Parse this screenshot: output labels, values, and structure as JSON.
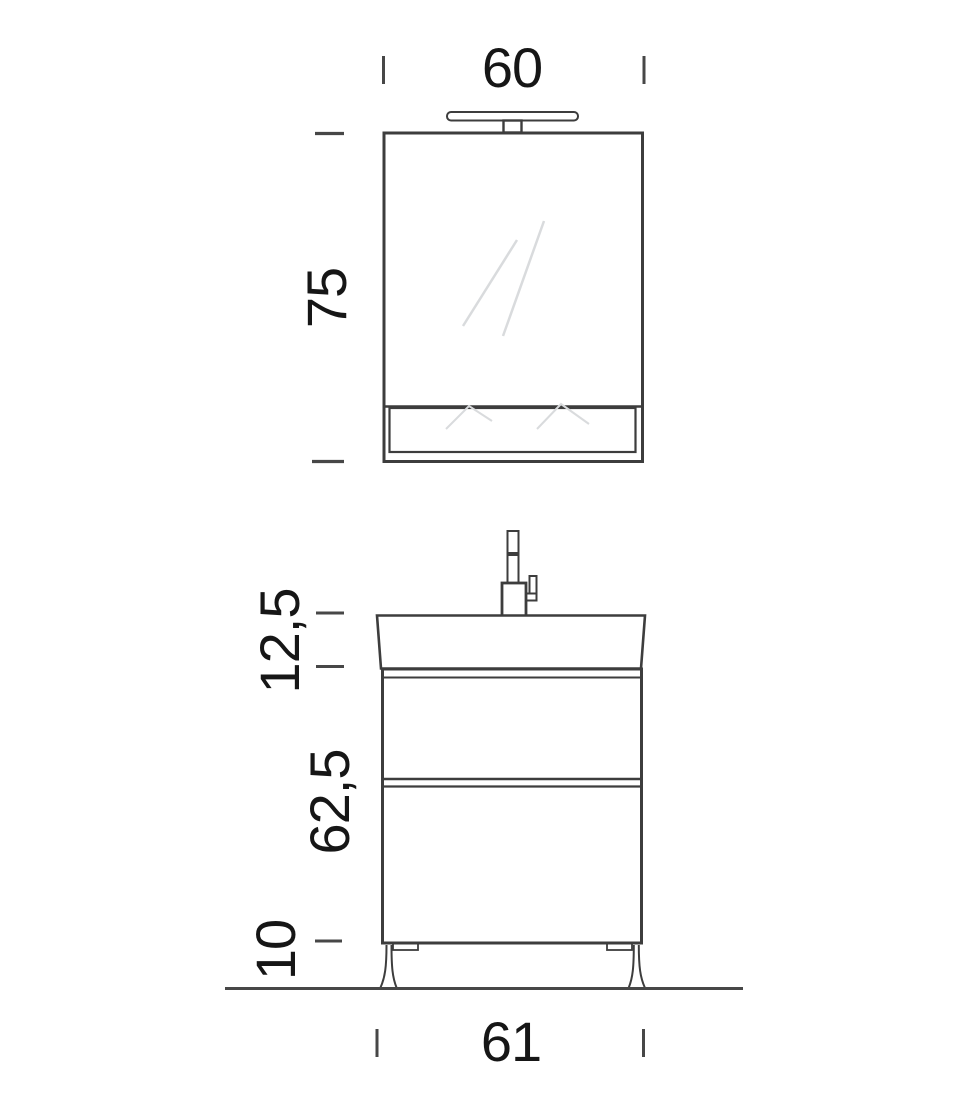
{
  "figure": {
    "colors": {
      "background": "#ffffff",
      "line": "#3d3d3d",
      "tick": "#474747",
      "shine": "#d9dbdd",
      "text": "#161616"
    },
    "dimensions": {
      "mirror_width": "60",
      "mirror_height": "75",
      "basin_height": "12,5",
      "vanity_body_height": "62,5",
      "legs_height": "10",
      "vanity_width": "61"
    }
  }
}
